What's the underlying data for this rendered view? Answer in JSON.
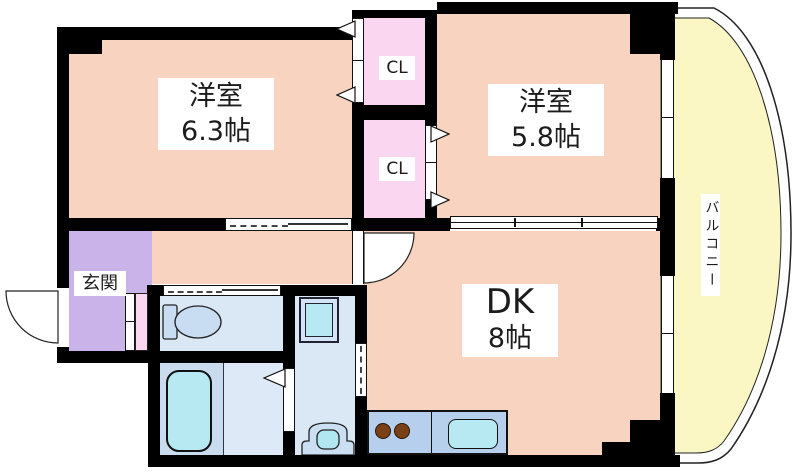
{
  "rooms": {
    "western_left": {
      "name": "洋室",
      "size": "6.3帖"
    },
    "western_right": {
      "name": "洋室",
      "size": "5.8帖"
    },
    "dining_kitchen": {
      "name": "DK",
      "size": "8帖"
    },
    "entrance": {
      "label": "玄関"
    },
    "closet_upper": {
      "label": "CL"
    },
    "closet_lower": {
      "label": "CL"
    },
    "balcony": {
      "label": "バルコニー"
    }
  },
  "colors": {
    "room": "#F8D3BF",
    "closet": "#FBD6F1",
    "entrance": "#C9B3E8",
    "wetroom": "#DAE8F6",
    "bath-floor": "#C9DCEF",
    "bath-floor-light": "#DDE9F7",
    "fixture": "#B7E9F2",
    "counter": "#B5CFEC",
    "balcony": "#FAF7C4",
    "burner": "#7B4116",
    "wall": "#000000"
  }
}
